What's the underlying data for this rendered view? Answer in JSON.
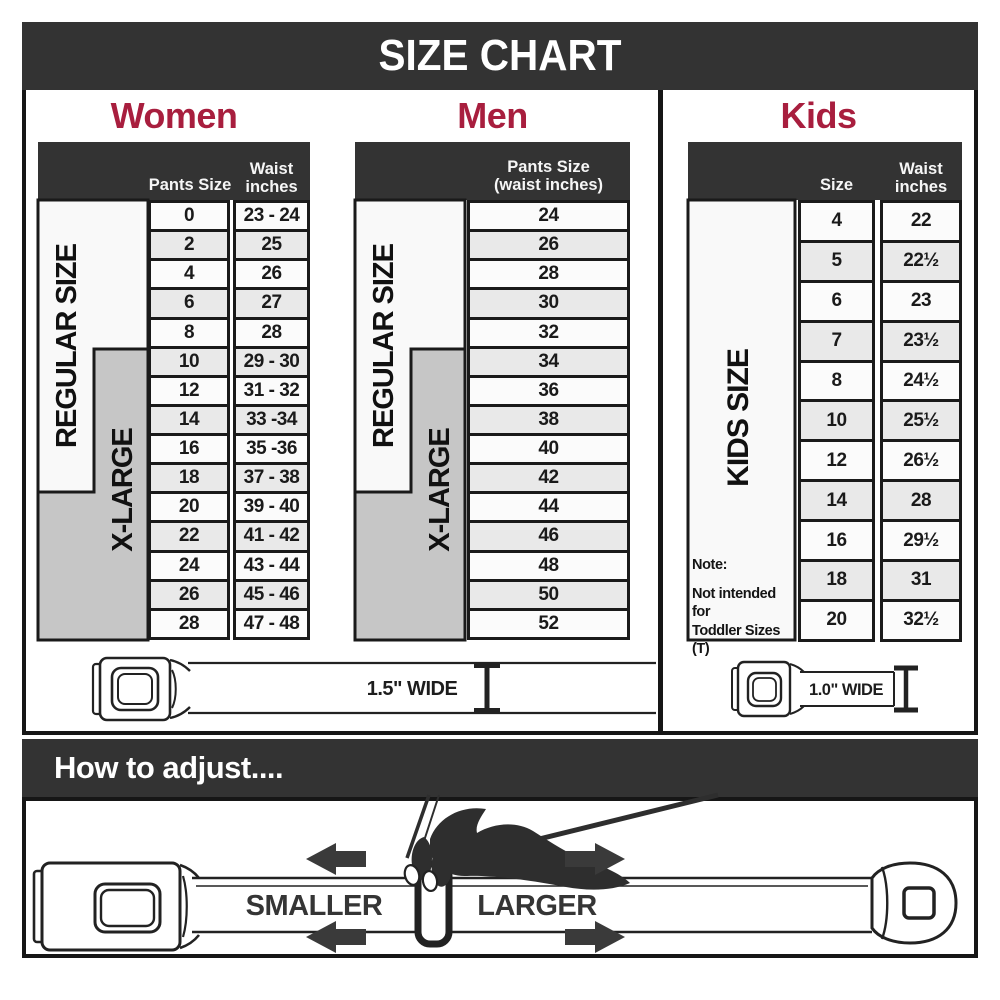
{
  "title": "SIZE CHART",
  "colors": {
    "accent": "#A81E3E",
    "header_bar": "#333333",
    "row_alt": "#E9E9E9",
    "xlarge_gray": "#C6C6C6"
  },
  "sections": {
    "women": {
      "label": "Women",
      "col1_header": "Pants Size",
      "col2_header_lines": [
        "Waist",
        "inches"
      ],
      "regular_label": "REGULAR SIZE",
      "xlarge_label": "X-LARGE",
      "rows": [
        {
          "size": "0",
          "waist": "23 - 24"
        },
        {
          "size": "2",
          "waist": "25"
        },
        {
          "size": "4",
          "waist": "26"
        },
        {
          "size": "6",
          "waist": "27"
        },
        {
          "size": "8",
          "waist": "28"
        },
        {
          "size": "10",
          "waist": "29 - 30"
        },
        {
          "size": "12",
          "waist": "31 - 32"
        },
        {
          "size": "14",
          "waist": "33 -34"
        },
        {
          "size": "16",
          "waist": "35 -36"
        },
        {
          "size": "18",
          "waist": "37 - 38"
        },
        {
          "size": "20",
          "waist": "39 - 40"
        },
        {
          "size": "22",
          "waist": "41 - 42"
        },
        {
          "size": "24",
          "waist": "43 - 44"
        },
        {
          "size": "26",
          "waist": "45 - 46"
        },
        {
          "size": "28",
          "waist": "47 - 48"
        }
      ]
    },
    "men": {
      "label": "Men",
      "col_header_lines": [
        "Pants Size",
        "(waist inches)"
      ],
      "regular_label": "REGULAR SIZE",
      "xlarge_label": "X-LARGE",
      "rows": [
        "24",
        "26",
        "28",
        "30",
        "32",
        "34",
        "36",
        "38",
        "40",
        "42",
        "44",
        "46",
        "48",
        "50",
        "52"
      ]
    },
    "kids": {
      "label": "Kids",
      "col1_header": "Size",
      "col2_header_lines": [
        "Waist",
        "inches"
      ],
      "side_label": "KIDS SIZE",
      "note_lines": [
        "Note:",
        "Not intended for",
        "Toddler Sizes (T)"
      ],
      "rows": [
        {
          "size": "4",
          "waist": "22"
        },
        {
          "size": "5",
          "waist": "22½"
        },
        {
          "size": "6",
          "waist": "23"
        },
        {
          "size": "7",
          "waist": "23½"
        },
        {
          "size": "8",
          "waist": "24½"
        },
        {
          "size": "10",
          "waist": "25½"
        },
        {
          "size": "12",
          "waist": "26½"
        },
        {
          "size": "14",
          "waist": "28"
        },
        {
          "size": "16",
          "waist": "29½"
        },
        {
          "size": "18",
          "waist": "31"
        },
        {
          "size": "20",
          "waist": "32½"
        }
      ]
    }
  },
  "belts": {
    "adult_label": "1.5\" WIDE",
    "kids_label": "1.0\" WIDE"
  },
  "adjust": {
    "heading": "How to adjust....",
    "smaller_label": "SMALLER",
    "larger_label": "LARGER"
  }
}
